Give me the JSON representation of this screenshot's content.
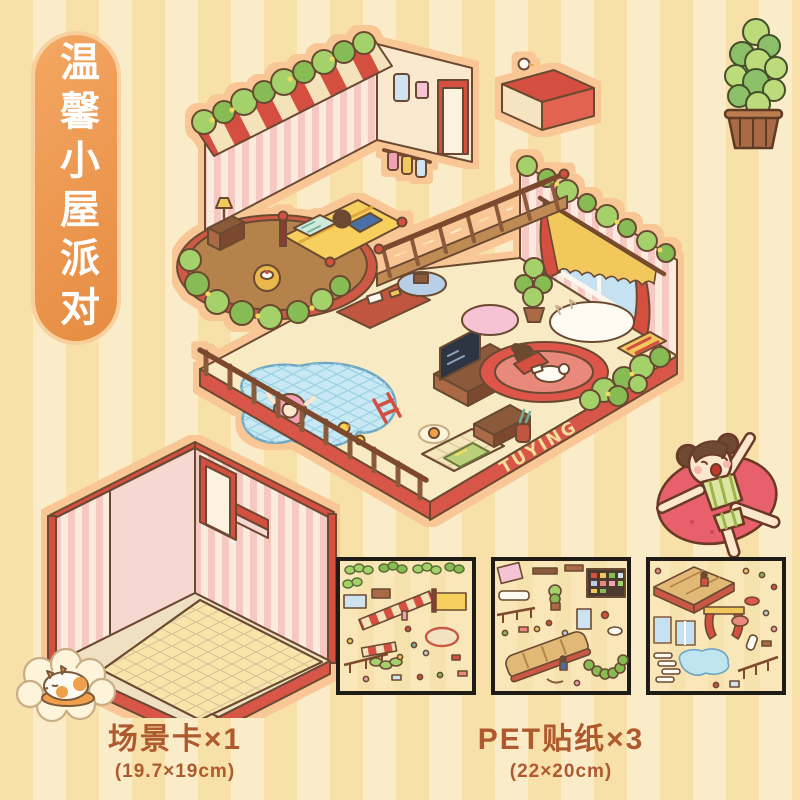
{
  "page": {
    "type": "product-listing-image",
    "background": {
      "stripe_dark": "#F8E0A9",
      "stripe_light": "#FBECC9",
      "stripe_width_px": 33
    }
  },
  "ribbon_badge": {
    "text": "温馨小屋派对",
    "bg_color": "#EC9750",
    "text_color": "#FFFFFF"
  },
  "house": {
    "brand_text": "TUYING",
    "rooms_depicted": "bedroom, wardrobe corner, study, living room with TV, pool terrace, entrance",
    "colors": {
      "base_red": "#D85747",
      "roof_stripe_red": "#D5503F",
      "roof_stripe_cream": "#F4E2BB",
      "bush_green_light": "#A4D16A",
      "bush_green_dark": "#86BC52",
      "wallpaper_pink": "#F5C9C1",
      "wallpaper_cream": "#FBEBDF",
      "floor_cream": "#F8EAC3",
      "pool_blue": "#C8E9F4",
      "wood_brown": "#8A5A3B",
      "accent_yellow": "#F2C75C"
    }
  },
  "products": {
    "scene_card": {
      "caption": "场景卡×1",
      "dimensions": "(19.7×19cm)"
    },
    "stickers": {
      "caption": "PET贴纸×3",
      "dimensions": "(22×20cm)",
      "sheet_count": 3
    }
  },
  "illustrations": {
    "potted_plant": "potted-succulent-plant",
    "swim_ring_girl": "girl-on-red-swim-ring",
    "sleeping_cat": "cat-sleeping-in-cloud",
    "scene_card_room": "empty-isometric-room-card",
    "main_house": "isometric-dollhouse-cutaway"
  }
}
